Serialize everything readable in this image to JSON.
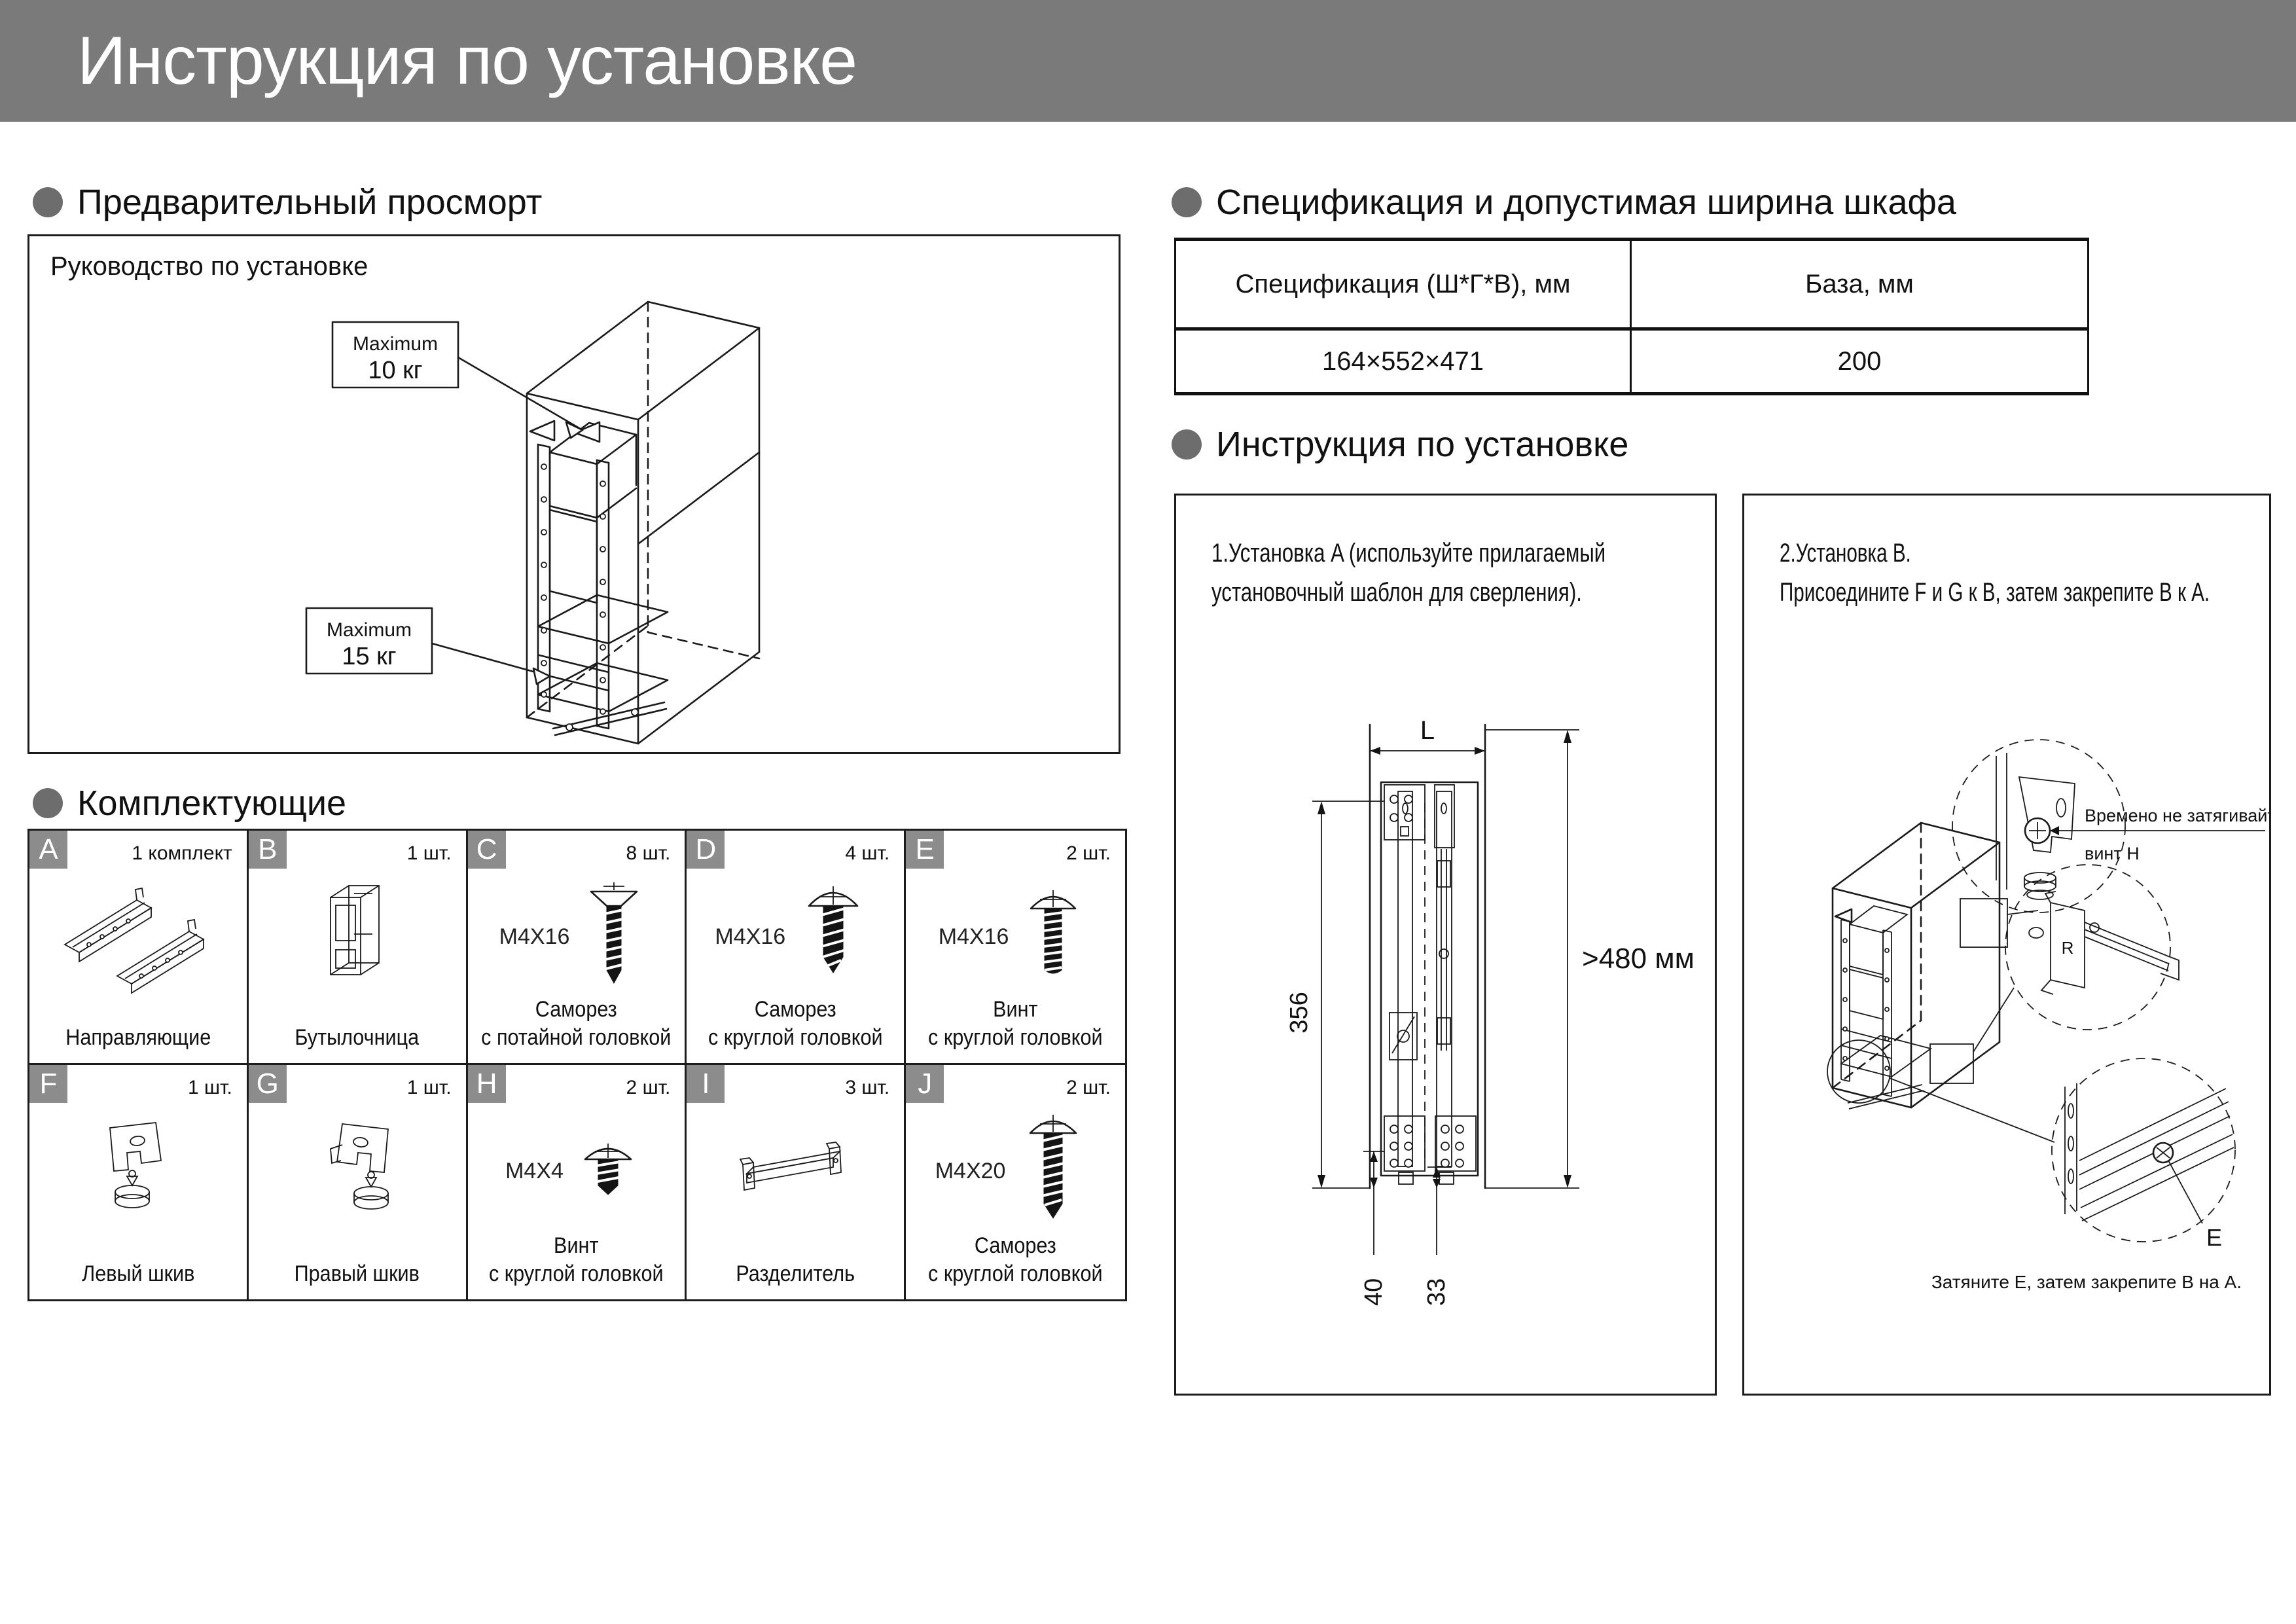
{
  "banner": {
    "title": "Инструкция по установке"
  },
  "sections": {
    "preview": "Предварительный просморт",
    "spec": "Спецификация и допустимая ширина шкафа",
    "components": "Комплектующие",
    "install": "Инструкция по установке"
  },
  "preview": {
    "box_label": "Руководство по установке",
    "callout_top": {
      "line1": "Maximum",
      "line2": "10 кг"
    },
    "callout_bottom": {
      "line1": "Maximum",
      "line2": "15 кг"
    }
  },
  "spec_table": {
    "col1_header": "Спецификация (Ш*Г*В), мм",
    "col2_header": "База, мм",
    "col1_value": "164×552×471",
    "col2_value": "200"
  },
  "components": {
    "items": [
      {
        "letter": "A",
        "qty": "1 комплект",
        "size": "",
        "name": "Направляющие"
      },
      {
        "letter": "B",
        "qty": "1 шт.",
        "size": "",
        "name": "Бутылочница"
      },
      {
        "letter": "C",
        "qty": "8 шт.",
        "size": "M4X16",
        "name": "Саморез\nс потайной головкой"
      },
      {
        "letter": "D",
        "qty": "4 шт.",
        "size": "M4X16",
        "name": "Саморез\nс круглой головкой"
      },
      {
        "letter": "E",
        "qty": "2 шт.",
        "size": "M4X16",
        "name": "Винт\nс круглой головкой"
      },
      {
        "letter": "F",
        "qty": "1 шт.",
        "size": "",
        "name": "Левый шкив"
      },
      {
        "letter": "G",
        "qty": "1 шт.",
        "size": "",
        "name": "Правый шкив"
      },
      {
        "letter": "H",
        "qty": "2 шт.",
        "size": "M4X4",
        "name": "Винт\nс круглой головкой"
      },
      {
        "letter": "I",
        "qty": "3 шт.",
        "size": "",
        "name": "Разделитель"
      },
      {
        "letter": "J",
        "qty": "2 шт.",
        "size": "M4X20",
        "name": "Саморез\nс круглой головкой"
      }
    ]
  },
  "install": {
    "step1": {
      "text": "1.Установка A (используйте прилагаемый установочный шаблон для сверления)."
    },
    "step2": {
      "text": "2.Установка B.\nПрисоедините F и G к B, затем закрепите B к A.",
      "callout_line1": "Времено не затягивайте",
      "callout_line2": "винт H",
      "label_r": "R",
      "label_e": "E",
      "caption": "Затяните E, затем закрепите B на A."
    },
    "dims": {
      "top": "L",
      "right": ">480 мм",
      "left": "356",
      "bottom_outer": "40",
      "bottom_inner": "33"
    }
  }
}
